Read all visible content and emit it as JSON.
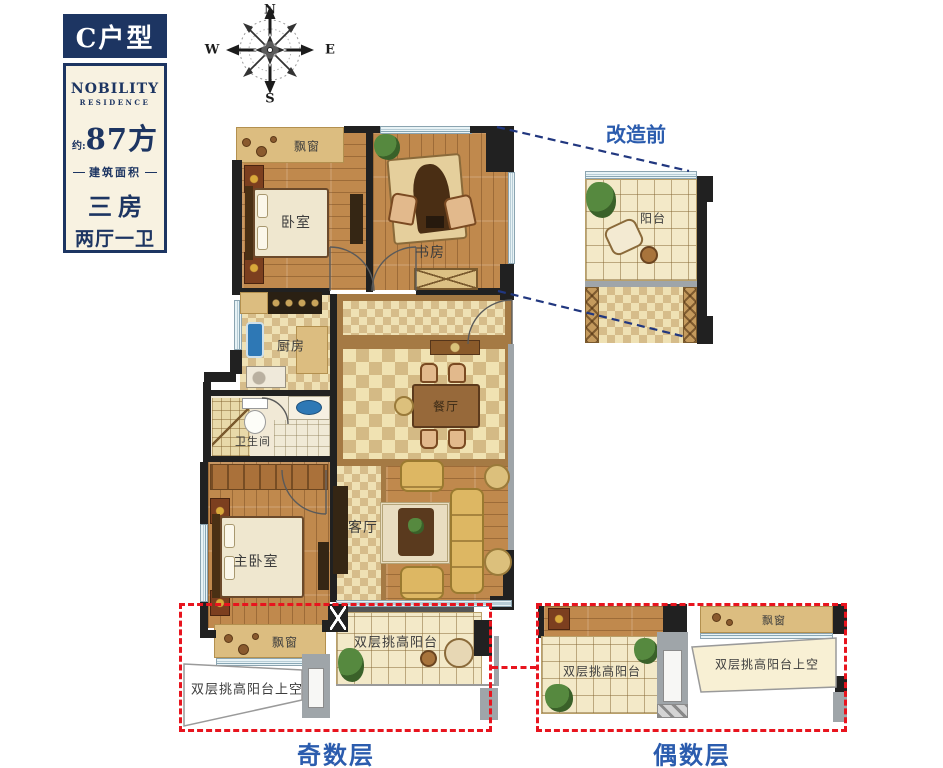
{
  "badge": {
    "title": "C户型"
  },
  "info_card": {
    "brand_line1": "NOBILITY",
    "brand_line2": "RESIDENCE",
    "area_prefix": "约:",
    "area_value": "87方",
    "area_caption": "建筑面积",
    "layout_line1": "三房",
    "layout_line2": "两厅一卫"
  },
  "compass": {
    "north": "N",
    "east": "E",
    "south": "S",
    "west": "W"
  },
  "rooms": {
    "bay_window_top": "飘窗",
    "bedroom": "卧室",
    "study": "书房",
    "kitchen": "厨房",
    "bathroom": "卫生间",
    "dining": "餐厅",
    "living": "客厅",
    "master_bedroom": "主卧室",
    "bay_window_bottom": "飘窗"
  },
  "annotations": {
    "before_title": "改造前",
    "before_balcony": "阳台",
    "odd_balcony": "双层挑高阳台",
    "odd_void": "双层挑高阳台上空",
    "odd_caption": "奇数层",
    "even_balcony": "双层挑高阳台",
    "even_void": "双层挑高阳台上空",
    "even_bay_window": "飘窗",
    "even_caption": "偶数层"
  },
  "colors": {
    "navy": "#1d3562",
    "label_blue": "#2b5cae",
    "annotation_red": "#e8141e",
    "projection_blue": "#21377f"
  }
}
